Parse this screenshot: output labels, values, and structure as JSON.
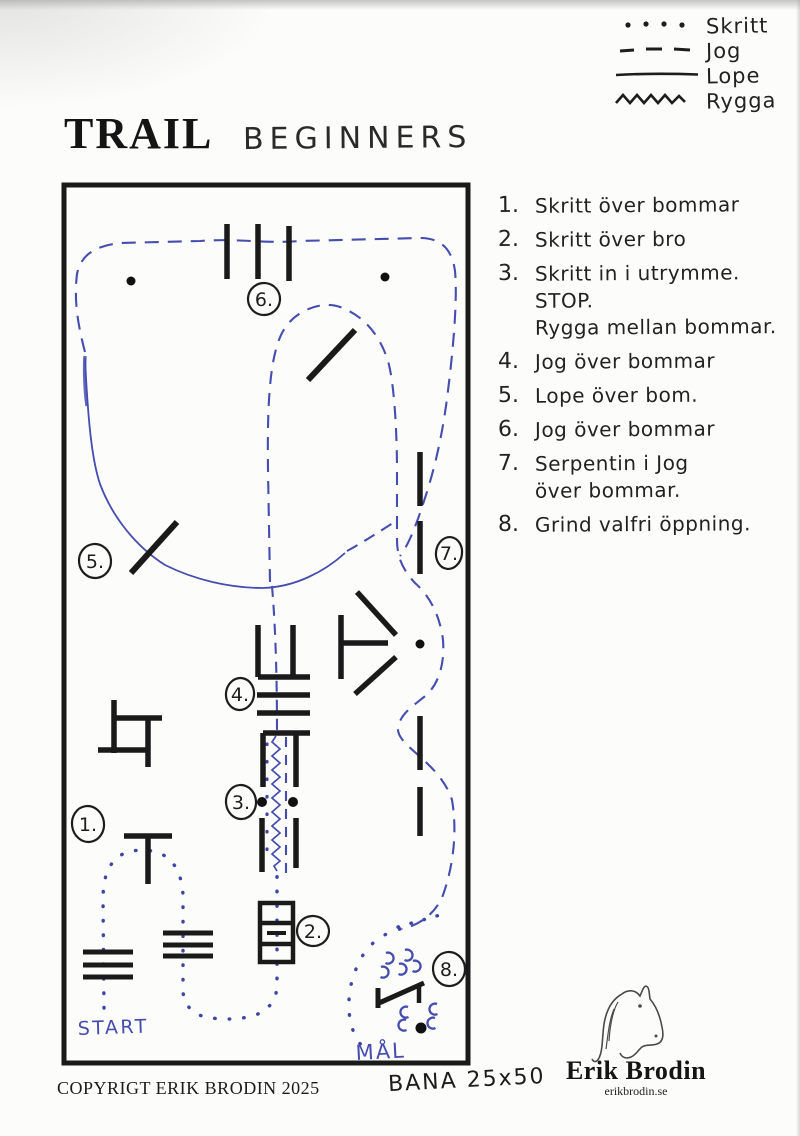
{
  "title": {
    "main": "TRAIL",
    "sub": "BEGINNERS"
  },
  "legend": {
    "items": [
      {
        "icon": "dotted-line",
        "label": "Skritt"
      },
      {
        "icon": "dashed-line",
        "label": "Jog"
      },
      {
        "icon": "solid-line",
        "label": "Lope"
      },
      {
        "icon": "zigzag-line",
        "label": "Rygga"
      }
    ]
  },
  "instructions": {
    "rows": [
      {
        "num": "1.",
        "text": "Skritt över bommar"
      },
      {
        "num": "2.",
        "text": "Skritt över bro"
      },
      {
        "num": "3.",
        "text": "Skritt in i utrymme."
      },
      {
        "num": "",
        "text": "STOP."
      },
      {
        "num": "",
        "text": "Rygga mellan bommar."
      },
      {
        "num": "4.",
        "text": "Jog över bommar"
      },
      {
        "num": "5.",
        "text": "Lope över bom."
      },
      {
        "num": "6.",
        "text": "Jog över bommar"
      },
      {
        "num": "7.",
        "text": "Serpentin i Jog"
      },
      {
        "num": "",
        "text": "över bommar."
      },
      {
        "num": "8.",
        "text": "Grind valfri öppning."
      }
    ]
  },
  "course": {
    "markers": [
      "1.",
      "2.",
      "3.",
      "4.",
      "5.",
      "6.",
      "7.",
      "8."
    ],
    "start_label": "START",
    "goal_label": "MÅL"
  },
  "footer": {
    "copyright": "COPYRIGT ERIK BRODIN 2025",
    "arena_size": "BANA 25x50"
  },
  "logo": {
    "name": "Erik Brodin",
    "website": "erikbrodin.se"
  },
  "colors": {
    "ink_black": "#1d1d1d",
    "path_blue": "#454daf"
  }
}
